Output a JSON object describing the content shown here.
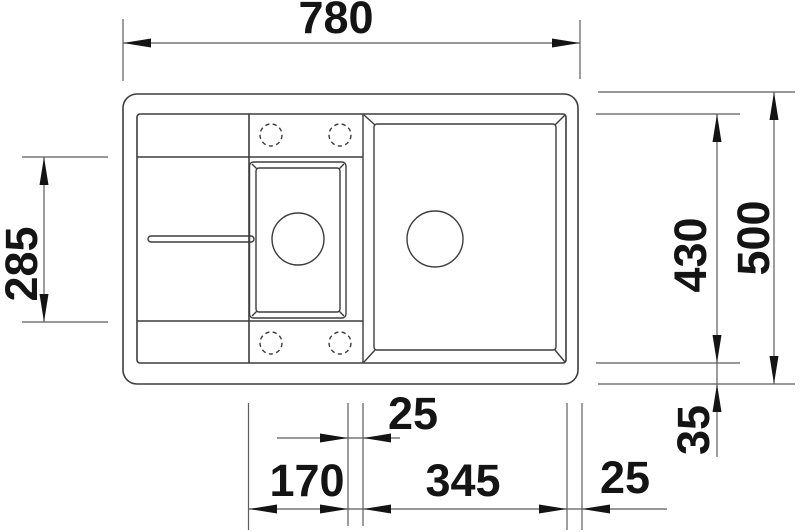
{
  "drawing": {
    "type": "technical-dimension-drawing",
    "subject": "kitchen sink top view with one and a half bowls and drainer",
    "unit": "mm",
    "labels": {
      "overall_width": "780",
      "left_section_depth": "285",
      "inner_depth": "430",
      "overall_depth": "500",
      "bottom_rim": "35",
      "bowl_gap": "25",
      "small_bowl_width": "170",
      "main_bowl_width": "345",
      "right_rim": "25"
    },
    "colors": {
      "background": "#ffffff",
      "outline": "#3d3d3d",
      "dimension_line": "#5c5c5c",
      "text": "#141414"
    }
  }
}
